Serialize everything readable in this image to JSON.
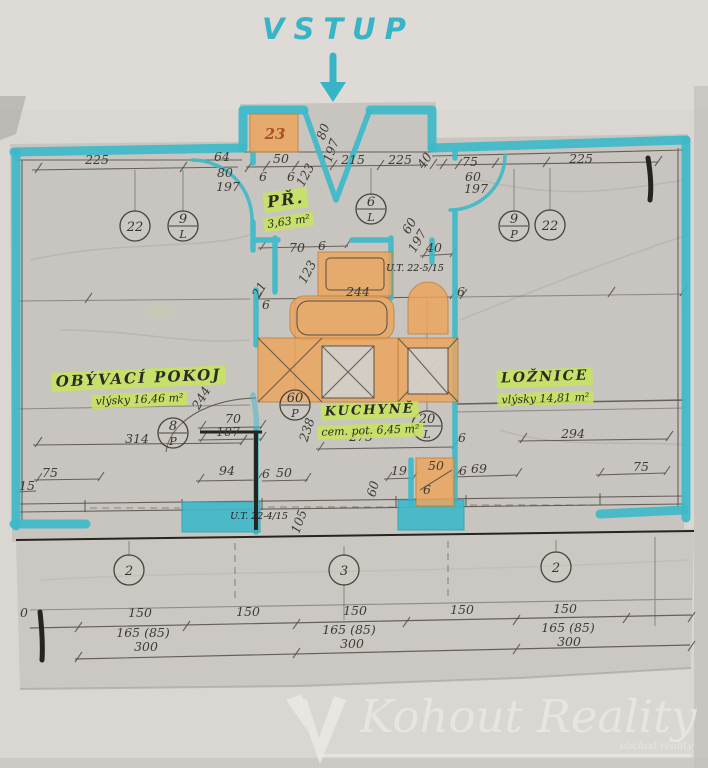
{
  "entrance": {
    "label": "VSTUP"
  },
  "rooms": {
    "hall": {
      "name": "PŘ.",
      "area": "3,63 m²"
    },
    "living": {
      "name": "OBÝVACÍ POKOJ",
      "floor_note": "vlýsky",
      "area": "16,46 m²"
    },
    "kitchen": {
      "name": "KUCHYNĚ",
      "floor_note": "cem. pot.",
      "area": "6,45 m²"
    },
    "bedroom": {
      "name": "LOŽNICE",
      "floor_note": "vlýsky",
      "area": "14,81 m²"
    }
  },
  "watermark": {
    "brand": "Kohout Reality",
    "tagline": "obchod reality"
  },
  "colors": {
    "highlighter_teal": "#3eb8c8",
    "furniture_orange": "#efa55b",
    "label_green": "#c6e45c",
    "pencil": "#3e3b34"
  },
  "markers": [
    {
      "x": 135,
      "y": 226,
      "label": "22"
    },
    {
      "x": 183,
      "y": 226,
      "label": "9",
      "sub": "L"
    },
    {
      "x": 371,
      "y": 209,
      "label": "6",
      "sub": "L"
    },
    {
      "x": 514,
      "y": 226,
      "label": "9",
      "sub": "P"
    },
    {
      "x": 550,
      "y": 225,
      "label": "22"
    },
    {
      "x": 173,
      "y": 433,
      "label": "8",
      "sub": "P"
    },
    {
      "x": 295,
      "y": 405,
      "label": "60",
      "sub": "P"
    },
    {
      "x": 427,
      "y": 426,
      "label": "20",
      "sub": "L"
    },
    {
      "x": 129,
      "y": 570,
      "label": "2"
    },
    {
      "x": 344,
      "y": 570,
      "label": "3"
    },
    {
      "x": 556,
      "y": 567,
      "label": "2"
    }
  ],
  "dimensions": [
    {
      "x": 97,
      "y": 164,
      "t": "225"
    },
    {
      "x": 222,
      "y": 161,
      "t": "64"
    },
    {
      "x": 225,
      "y": 177,
      "t": "80"
    },
    {
      "x": 228,
      "y": 191,
      "t": "197"
    },
    {
      "x": 281,
      "y": 163,
      "t": "50"
    },
    {
      "x": 263,
      "y": 181,
      "t": "6"
    },
    {
      "x": 291,
      "y": 181,
      "t": "6"
    },
    {
      "x": 309,
      "y": 177,
      "t": "123",
      "r": -62
    },
    {
      "x": 353,
      "y": 164,
      "t": "215"
    },
    {
      "x": 400,
      "y": 164,
      "t": "225"
    },
    {
      "x": 428,
      "y": 163,
      "t": "40",
      "r": -55
    },
    {
      "x": 470,
      "y": 166,
      "t": "75"
    },
    {
      "x": 473,
      "y": 181,
      "t": "60"
    },
    {
      "x": 476,
      "y": 193,
      "t": "197"
    },
    {
      "x": 581,
      "y": 163,
      "t": "225"
    },
    {
      "x": 327,
      "y": 133,
      "t": "80",
      "r": -70
    },
    {
      "x": 335,
      "y": 152,
      "t": "197",
      "r": -70
    },
    {
      "x": 413,
      "y": 228,
      "t": "60",
      "r": -60
    },
    {
      "x": 421,
      "y": 243,
      "t": "197",
      "r": -60
    },
    {
      "x": 297,
      "y": 252,
      "t": "70"
    },
    {
      "x": 322,
      "y": 250,
      "t": "6"
    },
    {
      "x": 311,
      "y": 274,
      "t": "123",
      "r": -62
    },
    {
      "x": 434,
      "y": 252,
      "t": "40"
    },
    {
      "x": 358,
      "y": 296,
      "t": "244"
    },
    {
      "x": 263,
      "y": 292,
      "t": "21",
      "r": -60
    },
    {
      "x": 266,
      "y": 309,
      "t": "6"
    },
    {
      "x": 461,
      "y": 296,
      "t": "6"
    },
    {
      "x": 205,
      "y": 400,
      "t": "244",
      "r": -60
    },
    {
      "x": 233,
      "y": 423,
      "t": "70"
    },
    {
      "x": 228,
      "y": 436,
      "t": "107"
    },
    {
      "x": 311,
      "y": 431,
      "t": "238",
      "r": -72
    },
    {
      "x": 361,
      "y": 441,
      "t": "275"
    },
    {
      "x": 137,
      "y": 443,
      "t": "314"
    },
    {
      "x": 573,
      "y": 438,
      "t": "294"
    },
    {
      "x": 462,
      "y": 442,
      "t": "6"
    },
    {
      "x": 50,
      "y": 477,
      "t": "75"
    },
    {
      "x": 27,
      "y": 490,
      "t": "15"
    },
    {
      "x": 227,
      "y": 475,
      "t": "94"
    },
    {
      "x": 266,
      "y": 478,
      "t": "6"
    },
    {
      "x": 284,
      "y": 477,
      "t": "50"
    },
    {
      "x": 399,
      "y": 475,
      "t": "19"
    },
    {
      "x": 377,
      "y": 490,
      "t": "60",
      "r": -75
    },
    {
      "x": 436,
      "y": 470,
      "t": "50"
    },
    {
      "x": 427,
      "y": 494,
      "t": "6"
    },
    {
      "x": 463,
      "y": 475,
      "t": "6"
    },
    {
      "x": 479,
      "y": 473,
      "t": "69"
    },
    {
      "x": 641,
      "y": 471,
      "t": "75"
    },
    {
      "x": 303,
      "y": 523,
      "t": "105",
      "r": -70
    },
    {
      "x": 24,
      "y": 617,
      "t": "0"
    },
    {
      "x": 140,
      "y": 617,
      "t": "150"
    },
    {
      "x": 248,
      "y": 616,
      "t": "150"
    },
    {
      "x": 355,
      "y": 615,
      "t": "150"
    },
    {
      "x": 462,
      "y": 614,
      "t": "150"
    },
    {
      "x": 565,
      "y": 613,
      "t": "150"
    },
    {
      "x": 143,
      "y": 637,
      "t": "165 (85)"
    },
    {
      "x": 349,
      "y": 634,
      "t": "165 (85)"
    },
    {
      "x": 568,
      "y": 632,
      "t": "165 (85)"
    },
    {
      "x": 146,
      "y": 651,
      "t": "300"
    },
    {
      "x": 352,
      "y": 648,
      "t": "300"
    },
    {
      "x": 569,
      "y": 646,
      "t": "300"
    },
    {
      "x": 275,
      "y": 139,
      "t": "23",
      "cls": "red"
    }
  ],
  "notes": [
    {
      "x": 259,
      "y": 519,
      "t": "U.T. 22-4/15"
    },
    {
      "x": 415,
      "y": 271,
      "t": "U.T. 22-5/15"
    }
  ]
}
